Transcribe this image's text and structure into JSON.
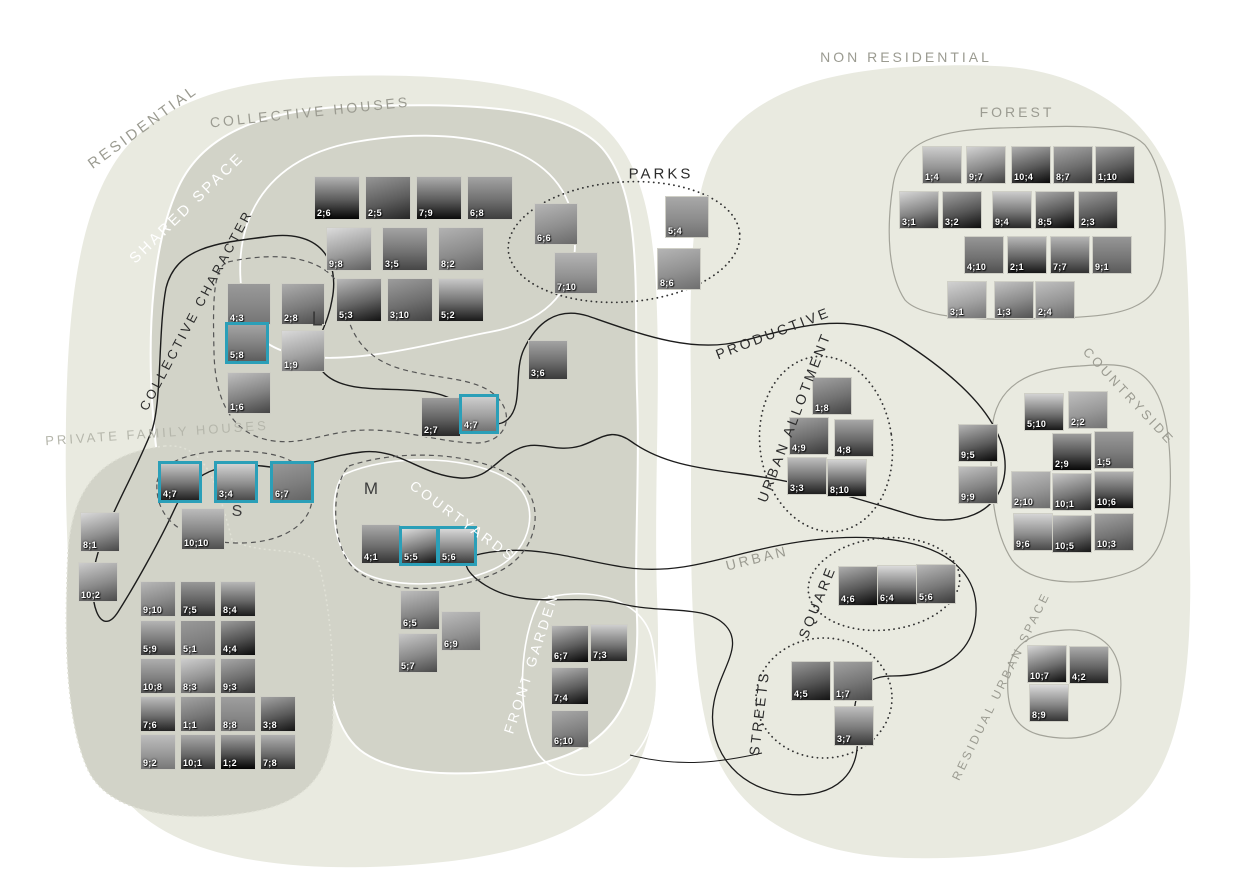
{
  "diagram": {
    "accent": "#2b9fb8",
    "colors": {
      "outer_blob": "#e9eae0",
      "inner_blob": "#d2d3c8",
      "gray_outline": "#a3a399",
      "black_line": "#1c1c1c",
      "white_line": "#ffffff"
    },
    "labels": [
      {
        "text": "RESIDENTIAL",
        "x": 143,
        "y": 127,
        "rot": -36,
        "variant": "gray",
        "size": 15
      },
      {
        "text": "COLLECTIVE HOUSES",
        "x": 310,
        "y": 112,
        "rot": -6,
        "variant": "gray",
        "size": 14
      },
      {
        "text": "SHARED SPACE",
        "x": 187,
        "y": 208,
        "rot": -44,
        "variant": "white",
        "size": 15
      },
      {
        "text": "COLLECTIVE CHARACTER",
        "x": 196,
        "y": 310,
        "rot": -62,
        "variant": "black",
        "size": 13
      },
      {
        "text": "PRIVATE FAMILY HOUSES",
        "x": 157,
        "y": 433,
        "rot": -4,
        "variant": "lightgray",
        "size": 13
      },
      {
        "text": "PARKS",
        "x": 661,
        "y": 174,
        "rot": 0,
        "variant": "black",
        "size": 15
      },
      {
        "text": "NON RESIDENTIAL",
        "x": 906,
        "y": 57,
        "rot": 0,
        "variant": "gray",
        "size": 14
      },
      {
        "text": "FOREST",
        "x": 1017,
        "y": 112,
        "rot": 0,
        "variant": "gray",
        "size": 14
      },
      {
        "text": "PRODUCTIVE",
        "x": 773,
        "y": 333,
        "rot": -21,
        "variant": "black",
        "size": 14
      },
      {
        "text": "URBAN ALLOTMENT",
        "x": 794,
        "y": 417,
        "rot": -69,
        "variant": "black",
        "size": 14
      },
      {
        "text": "COUNTRYSIDE",
        "x": 1129,
        "y": 396,
        "rot": 47,
        "variant": "gray",
        "size": 13
      },
      {
        "text": "URBAN",
        "x": 757,
        "y": 558,
        "rot": -14,
        "variant": "gray",
        "size": 14
      },
      {
        "text": "SQUARE",
        "x": 817,
        "y": 602,
        "rot": -68,
        "variant": "black",
        "size": 14
      },
      {
        "text": "STREETS",
        "x": 759,
        "y": 713,
        "rot": -83,
        "variant": "black",
        "size": 14
      },
      {
        "text": "FRONT GARDEN",
        "x": 531,
        "y": 663,
        "rot": -72,
        "variant": "white",
        "size": 14
      },
      {
        "text": "COURTYARDS",
        "x": 463,
        "y": 521,
        "rot": 36,
        "variant": "white",
        "size": 14
      },
      {
        "text": "RESIDUAL URBAN SPACE",
        "x": 1001,
        "y": 686,
        "rot": -64,
        "variant": "gray",
        "size": 12
      }
    ],
    "letters": [
      {
        "text": "L",
        "x": 317,
        "y": 320,
        "size": 20
      },
      {
        "text": "S",
        "x": 237,
        "y": 512,
        "size": 16
      },
      {
        "text": "M",
        "x": 371,
        "y": 489,
        "size": 17
      }
    ],
    "groups": [
      {
        "name": "shared-space",
        "w": 46,
        "h": 44,
        "items": [
          {
            "id": "2;6",
            "x": 314,
            "y": 176
          },
          {
            "id": "2;5",
            "x": 365,
            "y": 176
          },
          {
            "id": "7;9",
            "x": 416,
            "y": 176
          },
          {
            "id": "6;8",
            "x": 467,
            "y": 176
          },
          {
            "id": "9;8",
            "x": 326,
            "y": 227
          },
          {
            "id": "3;5",
            "x": 382,
            "y": 227
          },
          {
            "id": "8;2",
            "x": 438,
            "y": 227
          },
          {
            "id": "5;3",
            "x": 336,
            "y": 278
          },
          {
            "id": "3;10",
            "x": 387,
            "y": 278
          },
          {
            "id": "5;2",
            "x": 438,
            "y": 278
          }
        ]
      },
      {
        "name": "collective-character",
        "w": 44,
        "h": 42,
        "items": [
          {
            "id": "4;3",
            "x": 227,
            "y": 283
          },
          {
            "id": "2;8",
            "x": 281,
            "y": 283
          },
          {
            "id": "5;8",
            "x": 225,
            "y": 322,
            "hl": true
          },
          {
            "id": "1;9",
            "x": 281,
            "y": 330
          },
          {
            "id": "1;6",
            "x": 227,
            "y": 372
          }
        ]
      },
      {
        "name": "collective-mid",
        "w": 40,
        "h": 40,
        "items": [
          {
            "id": "2;7",
            "x": 421,
            "y": 397
          },
          {
            "id": "4;7",
            "x": 459,
            "y": 394,
            "hl": true
          }
        ]
      },
      {
        "name": "parks",
        "w": 44,
        "h": 42,
        "items": [
          {
            "id": "6;6",
            "x": 534,
            "y": 203
          },
          {
            "id": "7;10",
            "x": 554,
            "y": 252
          },
          {
            "id": "5;4",
            "x": 665,
            "y": 196
          },
          {
            "id": "8;6",
            "x": 657,
            "y": 248
          }
        ]
      },
      {
        "name": "parks-link",
        "w": 40,
        "h": 40,
        "items": [
          {
            "id": "3;6",
            "x": 528,
            "y": 340
          }
        ]
      },
      {
        "name": "private-family-s",
        "w": 44,
        "h": 42,
        "items": [
          {
            "id": "4;7",
            "x": 158,
            "y": 461,
            "hl": true
          },
          {
            "id": "3;4",
            "x": 214,
            "y": 461,
            "hl": true
          },
          {
            "id": "6;7",
            "x": 270,
            "y": 461,
            "hl": true
          },
          {
            "id": "10;10",
            "x": 181,
            "y": 508
          }
        ]
      },
      {
        "name": "private-family-left",
        "w": 40,
        "h": 40,
        "items": [
          {
            "id": "8;1",
            "x": 80,
            "y": 512
          },
          {
            "id": "10;2",
            "x": 78,
            "y": 562
          }
        ]
      },
      {
        "name": "private-family-grid",
        "w": 36,
        "h": 36,
        "items": [
          {
            "id": "9;10",
            "x": 140,
            "y": 581
          },
          {
            "id": "7;5",
            "x": 180,
            "y": 581
          },
          {
            "id": "8;4",
            "x": 220,
            "y": 581
          },
          {
            "id": "5;9",
            "x": 140,
            "y": 620
          },
          {
            "id": "5;1",
            "x": 180,
            "y": 620
          },
          {
            "id": "4;4",
            "x": 220,
            "y": 620
          },
          {
            "id": "10;8",
            "x": 140,
            "y": 658
          },
          {
            "id": "8;3",
            "x": 180,
            "y": 658
          },
          {
            "id": "9;3",
            "x": 220,
            "y": 658
          },
          {
            "id": "7;6",
            "x": 140,
            "y": 696
          },
          {
            "id": "1;1",
            "x": 180,
            "y": 696
          },
          {
            "id": "8;8",
            "x": 220,
            "y": 696
          },
          {
            "id": "3;8",
            "x": 260,
            "y": 696
          },
          {
            "id": "9;2",
            "x": 140,
            "y": 734
          },
          {
            "id": "10;1",
            "x": 180,
            "y": 734
          },
          {
            "id": "1;2",
            "x": 220,
            "y": 734
          },
          {
            "id": "7;8",
            "x": 260,
            "y": 734
          }
        ]
      },
      {
        "name": "forest",
        "w": 40,
        "h": 38,
        "items": [
          {
            "id": "1;4",
            "x": 922,
            "y": 146
          },
          {
            "id": "9;7",
            "x": 966,
            "y": 146
          },
          {
            "id": "10;4",
            "x": 1011,
            "y": 146
          },
          {
            "id": "8;7",
            "x": 1053,
            "y": 146
          },
          {
            "id": "1;10",
            "x": 1095,
            "y": 146
          },
          {
            "id": "3;1",
            "x": 899,
            "y": 191
          },
          {
            "id": "3;2",
            "x": 942,
            "y": 191
          },
          {
            "id": "9;4",
            "x": 992,
            "y": 191
          },
          {
            "id": "8;5",
            "x": 1035,
            "y": 191
          },
          {
            "id": "2;3",
            "x": 1078,
            "y": 191
          },
          {
            "id": "4;10",
            "x": 964,
            "y": 236
          },
          {
            "id": "2;1",
            "x": 1007,
            "y": 236
          },
          {
            "id": "7;7",
            "x": 1050,
            "y": 236
          },
          {
            "id": "9;1",
            "x": 1092,
            "y": 236
          },
          {
            "id": "3;1",
            "x": 947,
            "y": 281
          },
          {
            "id": "1;3",
            "x": 994,
            "y": 281
          },
          {
            "id": "2;4",
            "x": 1035,
            "y": 281
          }
        ]
      },
      {
        "name": "urban-allotment",
        "w": 40,
        "h": 38,
        "items": [
          {
            "id": "1;8",
            "x": 812,
            "y": 377
          },
          {
            "id": "4;9",
            "x": 789,
            "y": 417
          },
          {
            "id": "4;8",
            "x": 834,
            "y": 419
          },
          {
            "id": "3;3",
            "x": 787,
            "y": 457
          },
          {
            "id": "8;10",
            "x": 827,
            "y": 459
          }
        ]
      },
      {
        "name": "productive-pair",
        "w": 40,
        "h": 38,
        "items": [
          {
            "id": "9;5",
            "x": 958,
            "y": 424
          },
          {
            "id": "9;9",
            "x": 958,
            "y": 466
          }
        ]
      },
      {
        "name": "countryside",
        "w": 40,
        "h": 38,
        "items": [
          {
            "id": "5;10",
            "x": 1024,
            "y": 393
          },
          {
            "id": "2;2",
            "x": 1068,
            "y": 391
          },
          {
            "id": "2;9",
            "x": 1052,
            "y": 433
          },
          {
            "id": "1;5",
            "x": 1094,
            "y": 431
          },
          {
            "id": "2;10",
            "x": 1011,
            "y": 471
          },
          {
            "id": "10;1",
            "x": 1052,
            "y": 473
          },
          {
            "id": "10;6",
            "x": 1094,
            "y": 471
          },
          {
            "id": "9;6",
            "x": 1013,
            "y": 513
          },
          {
            "id": "10;5",
            "x": 1052,
            "y": 515
          },
          {
            "id": "10;3",
            "x": 1094,
            "y": 513
          }
        ]
      },
      {
        "name": "courtyards",
        "w": 40,
        "h": 40,
        "items": [
          {
            "id": "4;1",
            "x": 361,
            "y": 524
          },
          {
            "id": "5;5",
            "x": 399,
            "y": 526,
            "hl": true
          },
          {
            "id": "5;6",
            "x": 437,
            "y": 526,
            "hl": true
          }
        ]
      },
      {
        "name": "courtyards-lower",
        "w": 40,
        "h": 40,
        "items": [
          {
            "id": "6;5",
            "x": 400,
            "y": 590
          },
          {
            "id": "6;9",
            "x": 441,
            "y": 611
          },
          {
            "id": "5;7",
            "x": 398,
            "y": 633
          }
        ]
      },
      {
        "name": "front-garden",
        "w": 38,
        "h": 38,
        "items": [
          {
            "id": "6;7",
            "x": 551,
            "y": 625
          },
          {
            "id": "7;3",
            "x": 590,
            "y": 624
          },
          {
            "id": "7;4",
            "x": 551,
            "y": 667
          },
          {
            "id": "6;10",
            "x": 551,
            "y": 710
          }
        ]
      },
      {
        "name": "square",
        "w": 40,
        "h": 40,
        "items": [
          {
            "id": "4;6",
            "x": 838,
            "y": 566
          },
          {
            "id": "6;4",
            "x": 877,
            "y": 565
          },
          {
            "id": "5;6",
            "x": 916,
            "y": 564
          }
        ]
      },
      {
        "name": "streets",
        "w": 40,
        "h": 40,
        "items": [
          {
            "id": "4;5",
            "x": 791,
            "y": 661
          },
          {
            "id": "1;7",
            "x": 833,
            "y": 661
          },
          {
            "id": "3;7",
            "x": 834,
            "y": 706
          }
        ]
      },
      {
        "name": "residual-urban-space",
        "w": 40,
        "h": 38,
        "items": [
          {
            "id": "10;7",
            "x": 1027,
            "y": 645
          },
          {
            "id": "4;2",
            "x": 1069,
            "y": 646
          },
          {
            "id": "8;9",
            "x": 1029,
            "y": 684
          }
        ]
      }
    ]
  }
}
